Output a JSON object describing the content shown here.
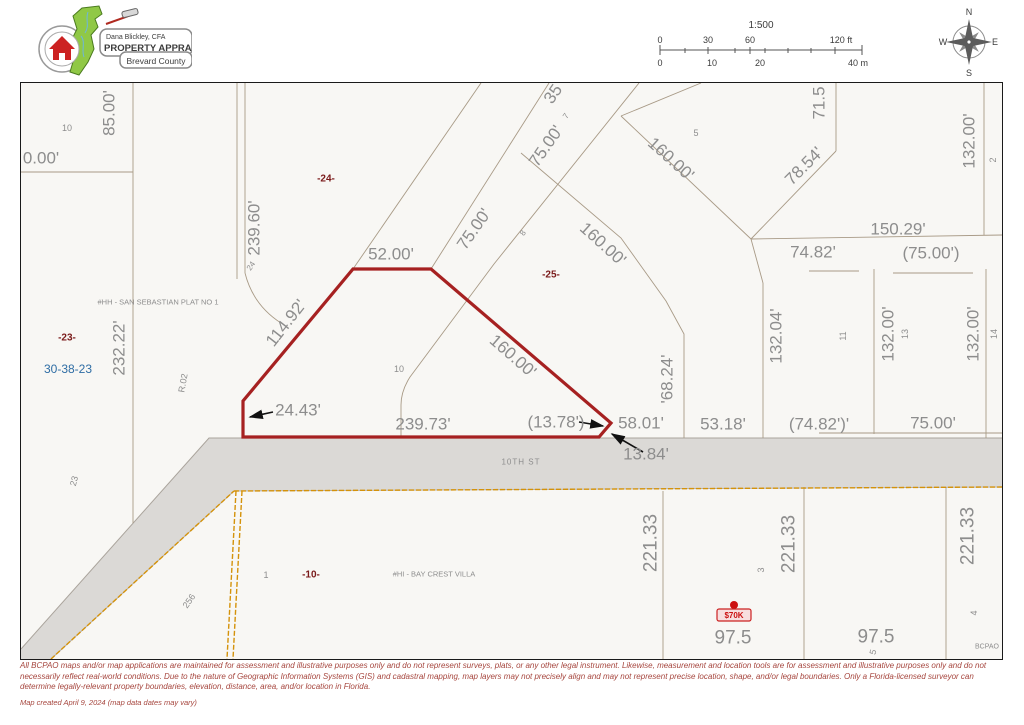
{
  "logo": {
    "line1": "Dana Blickley, CFA",
    "line2": "PROPERTY APPRAISER",
    "line3": "Brevard County"
  },
  "scale": {
    "ratio": "1:500",
    "ft_ticks": [
      "0",
      "30",
      "60",
      "120 ft"
    ],
    "m_ticks": [
      "0",
      "10",
      "20",
      "40 m"
    ]
  },
  "compass": {
    "n": "N",
    "e": "E",
    "s": "S",
    "w": "W"
  },
  "map": {
    "colors": {
      "dimension_gray": "#8d8d8d",
      "parcel_red": "#a62121",
      "boundary_orange": "#d4920a",
      "section_blue": "#2e6da4",
      "subdivision_red": "#7a1a1a",
      "road_gray": "#dbd9d6"
    },
    "value_badge": "$70K",
    "street": "10TH ST",
    "labels": [
      {
        "t": "85.00'",
        "x": 88,
        "y": 30,
        "r": -90,
        "s": 17
      },
      {
        "t": "10",
        "x": 46,
        "y": 45,
        "s": 9
      },
      {
        "t": "0.00'",
        "x": 20,
        "y": 75,
        "s": 17
      },
      {
        "t": "-24-",
        "x": 305,
        "y": 96,
        "s": 10,
        "c": "#7a1a1a",
        "b": 1
      },
      {
        "t": "239.60'",
        "x": 233,
        "y": 145,
        "r": -90,
        "s": 17
      },
      {
        "t": "24",
        "x": 230,
        "y": 183,
        "r": -55,
        "s": 8
      },
      {
        "t": "232.22'",
        "x": 98,
        "y": 265,
        "r": -90,
        "s": 17
      },
      {
        "t": "#HH - SAN SEBASTIAN PLAT NO 1",
        "x": 137,
        "y": 219,
        "s": 7.5
      },
      {
        "t": "-23-",
        "x": 46,
        "y": 255,
        "s": 10,
        "c": "#7a1a1a",
        "b": 1
      },
      {
        "t": "30-38-23",
        "x": 47,
        "y": 286,
        "s": 12,
        "c": "#2e6da4"
      },
      {
        "t": "R.02",
        "x": 162,
        "y": 300,
        "r": -80,
        "s": 9
      },
      {
        "t": "23",
        "x": 53,
        "y": 398,
        "r": -75,
        "s": 9
      },
      {
        "t": "256",
        "x": 168,
        "y": 518,
        "r": -55,
        "s": 9
      },
      {
        "t": "52.00'",
        "x": 370,
        "y": 171,
        "s": 17
      },
      {
        "t": "114.92'",
        "x": 265,
        "y": 240,
        "r": -52,
        "s": 17
      },
      {
        "t": "75.00'",
        "x": 453,
        "y": 146,
        "r": -55,
        "s": 17
      },
      {
        "t": "75.00'",
        "x": 525,
        "y": 63,
        "r": -55,
        "s": 17
      },
      {
        "t": "7",
        "x": 545,
        "y": 33,
        "r": -55,
        "s": 8
      },
      {
        "t": "35",
        "x": 532,
        "y": 11,
        "r": -55,
        "s": 17
      },
      {
        "t": "8",
        "x": 502,
        "y": 150,
        "r": -55,
        "s": 8
      },
      {
        "t": "-25-",
        "x": 530,
        "y": 192,
        "s": 10,
        "c": "#7a1a1a",
        "b": 1
      },
      {
        "t": "160.00'",
        "x": 492,
        "y": 273,
        "r": 41,
        "s": 17
      },
      {
        "t": "160.00'",
        "x": 582,
        "y": 161,
        "r": 42,
        "s": 17
      },
      {
        "t": "160.00'",
        "x": 650,
        "y": 76,
        "r": 42,
        "s": 17
      },
      {
        "t": "5",
        "x": 675,
        "y": 50,
        "s": 9
      },
      {
        "t": "78.54'",
        "x": 783,
        "y": 83,
        "r": -45,
        "s": 17
      },
      {
        "t": "71.5",
        "x": 798,
        "y": 20,
        "r": -90,
        "s": 17
      },
      {
        "t": "132.00'",
        "x": 948,
        "y": 58,
        "r": -90,
        "s": 17
      },
      {
        "t": "2",
        "x": 972,
        "y": 77,
        "r": -90,
        "s": 9
      },
      {
        "t": "150.29'",
        "x": 877,
        "y": 146,
        "s": 17
      },
      {
        "t": "74.82'",
        "x": 792,
        "y": 169,
        "s": 17
      },
      {
        "t": "(75.00')",
        "x": 910,
        "y": 170,
        "s": 17
      },
      {
        "t": "132.04'",
        "x": 755,
        "y": 253,
        "r": -90,
        "s": 17
      },
      {
        "t": "11",
        "x": 822,
        "y": 253,
        "r": -90,
        "s": 9
      },
      {
        "t": "132.00'",
        "x": 867,
        "y": 251,
        "r": -90,
        "s": 17
      },
      {
        "t": "13",
        "x": 884,
        "y": 251,
        "r": -90,
        "s": 9
      },
      {
        "t": "132.00'",
        "x": 952,
        "y": 251,
        "r": -90,
        "s": 17
      },
      {
        "t": "14",
        "x": 973,
        "y": 251,
        "r": -90,
        "s": 9
      },
      {
        "t": "10",
        "x": 378,
        "y": 286,
        "s": 9
      },
      {
        "t": "24.43'",
        "x": 277,
        "y": 327,
        "s": 17
      },
      {
        "t": "239.73'",
        "x": 402,
        "y": 341,
        "s": 17
      },
      {
        "t": "(13.78')",
        "x": 535,
        "y": 339,
        "s": 17
      },
      {
        "t": "58.01'",
        "x": 620,
        "y": 340,
        "s": 17
      },
      {
        "t": "13.84'",
        "x": 625,
        "y": 371,
        "s": 17
      },
      {
        "t": "'68.24'",
        "x": 646,
        "y": 296,
        "r": -90,
        "s": 17
      },
      {
        "t": "53.18'",
        "x": 702,
        "y": 341,
        "s": 17
      },
      {
        "t": "(74.82')'",
        "x": 798,
        "y": 341,
        "s": 17
      },
      {
        "t": "75.00'",
        "x": 912,
        "y": 340,
        "s": 17
      },
      {
        "t": "10TH ST",
        "x": 500,
        "y": 379,
        "s": 8,
        "ls": 1
      },
      {
        "t": "221.33",
        "x": 630,
        "y": 460,
        "r": -90,
        "s": 19
      },
      {
        "t": "221.33",
        "x": 768,
        "y": 461,
        "r": -90,
        "s": 19
      },
      {
        "t": "221.33",
        "x": 947,
        "y": 453,
        "r": -90,
        "s": 19
      },
      {
        "t": "3",
        "x": 740,
        "y": 487,
        "r": -90,
        "s": 9
      },
      {
        "t": "4",
        "x": 953,
        "y": 530,
        "r": -90,
        "s": 9
      },
      {
        "t": "97.5",
        "x": 712,
        "y": 555,
        "s": 19
      },
      {
        "t": "97.5",
        "x": 855,
        "y": 554,
        "s": 19
      },
      {
        "t": "5",
        "x": 852,
        "y": 569,
        "r": -75,
        "s": 9
      },
      {
        "t": "1",
        "x": 245,
        "y": 492,
        "s": 9
      },
      {
        "t": "-10-",
        "x": 290,
        "y": 492,
        "s": 10,
        "c": "#7a1a1a",
        "b": 1
      },
      {
        "t": "#HI - BAY CREST VILLA",
        "x": 413,
        "y": 491,
        "s": 7.5
      },
      {
        "t": "BCPAO",
        "x": 966,
        "y": 564,
        "s": 7
      }
    ]
  },
  "footer": {
    "disclaimer": "All BCPAO maps and/or map applications are maintained for assessment and illustrative purposes only and do not represent surveys, plats, or any other legal instrument. Likewise, measurement and location tools are for assessment and illustrative purposes only and do not necessarily reflect real-world conditions. Due to the nature of Geographic Information Systems (GIS) and cadastral mapping, map layers may not precisely align and may not represent precise location, shape, and/or legal boundaries. Only a Florida-licensed surveyor can determine legally-relevant property boundaries, elevation, distance, area, and/or location in Florida.",
    "created": "Map created April 9, 2024 (map data dates may vary)"
  }
}
